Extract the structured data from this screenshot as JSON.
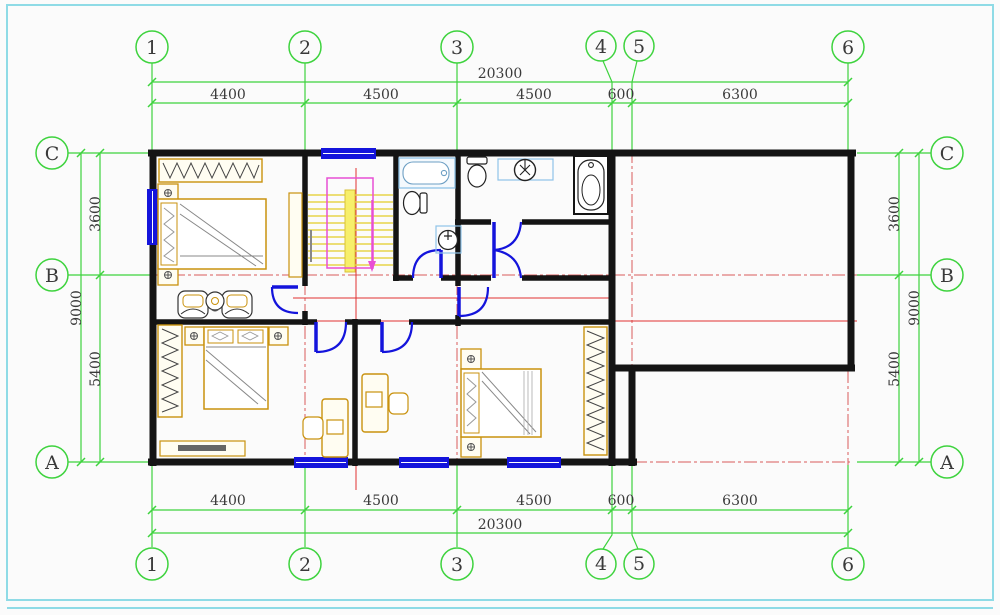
{
  "grid": {
    "columns": [
      "1",
      "2",
      "3",
      "4",
      "5",
      "6"
    ],
    "rows": [
      "C",
      "B",
      "A"
    ]
  },
  "dimensions": {
    "top": {
      "overall": "20300",
      "segments": [
        "4400",
        "4500",
        "4500",
        "600",
        "6300"
      ]
    },
    "bottom": {
      "overall": "20300",
      "segments": [
        "4400",
        "4500",
        "4500",
        "600",
        "6300"
      ]
    },
    "left": {
      "overall": "9000",
      "segments": [
        "3600",
        "5400"
      ]
    },
    "right": {
      "overall": "9000",
      "segments": [
        "3600",
        "5400"
      ]
    }
  },
  "colors": {
    "frame": "#8fdbe6",
    "grid_line": "#3ed33e",
    "wall": "#141414",
    "opening_blue": "#1414dc",
    "centerline_red": "#d95b5b",
    "section_red": "#e03030",
    "furniture_tan": "#c9920e",
    "fixture_blue": "#8fc3e8",
    "stair_tread_yellow": "#e8d44a",
    "stair_rail_magenta": "#e84fd4",
    "text": "#3a3a3a"
  }
}
